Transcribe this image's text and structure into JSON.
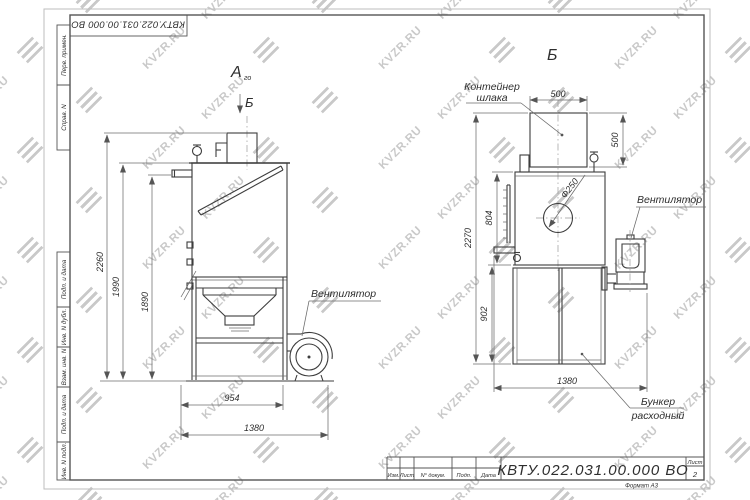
{
  "watermark": {
    "text": "KVZR.RU",
    "color": "#c9c9c9"
  },
  "stamp": {
    "designation": "КВТУ.022.031.00.000  ВО"
  },
  "margin_labels": [
    "Перв. примен.",
    "Справ. N",
    "Подп. и дата",
    "Инв. N дубл.",
    "Взам. инв. N",
    "Подп. и дата",
    "Инв. N подл."
  ],
  "front_view": {
    "view_label": "А",
    "view_label_sub": "го",
    "section_label": "Б",
    "fan_label": "Вентилятор",
    "dim_total_height": "2260",
    "dim_body_height": "1990",
    "dim_pipe_height": "1890",
    "dim_stand_width": "954",
    "dim_total_width": "1380"
  },
  "side_view": {
    "view_label": "Б",
    "container_label_line1": "Контейнер",
    "container_label_line2": "шлака",
    "fan_label": "Вентилятор",
    "hopper_label_line1": "Бункер",
    "hopper_label_line2": "расходный",
    "dim_container_width": "500",
    "dim_container_height": "500",
    "dim_total_height": "2270",
    "dim_body_height": "804",
    "dim_cabinet_height": "902",
    "dim_total_width": "1380",
    "dim_diameter": "Ф250"
  },
  "title_block": {
    "designation": "КВТУ.022.031.00.000  ВО",
    "columns": [
      "Изм.",
      "Лист",
      "N° докум.",
      "Подп.",
      "Дата"
    ],
    "sheet_label": "Лист",
    "sheet_number": "2",
    "format_label": "Формат А3"
  }
}
